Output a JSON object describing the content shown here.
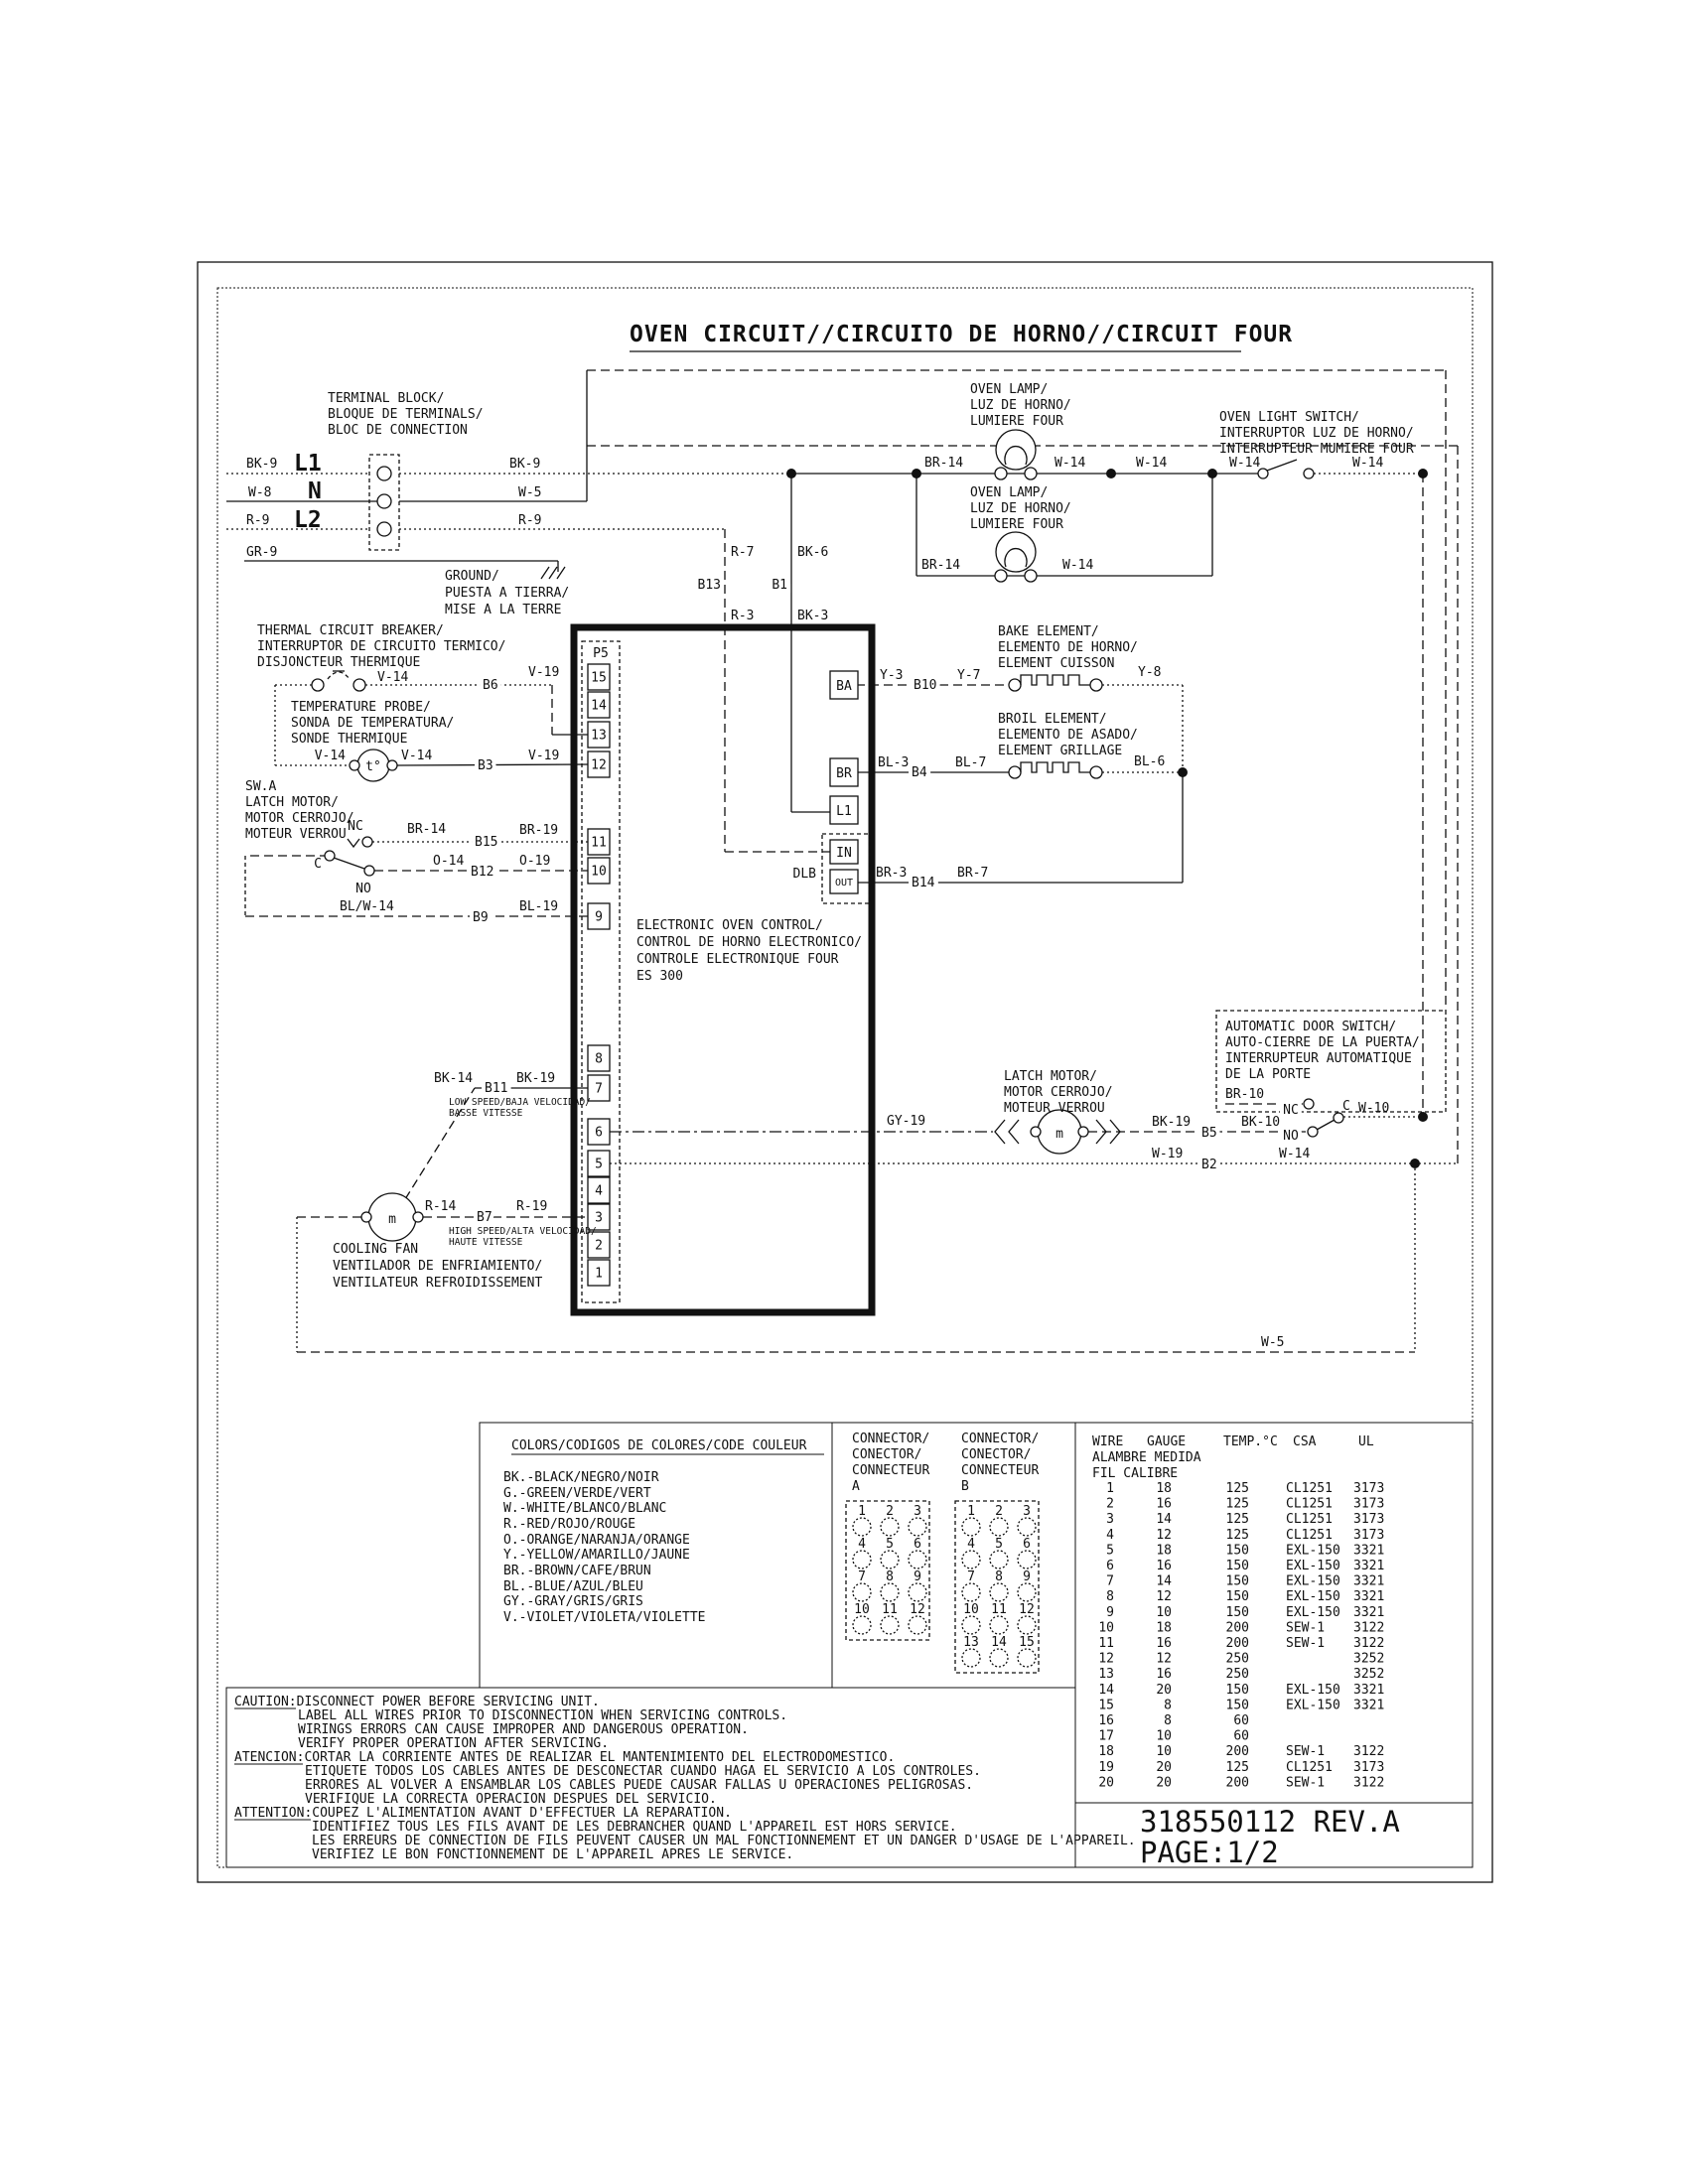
{
  "title": "OVEN CIRCUIT//CIRCUITO DE HORNO//CIRCUIT FOUR",
  "terminal": {
    "name": [
      "TERMINAL BLOCK/",
      "BLOQUE DE TERMINALS/",
      "BLOC DE CONNECTION"
    ],
    "l1": "L1",
    "n": "N",
    "l2": "L2",
    "bk9l": "BK-9",
    "w8": "W-8",
    "r9l": "R-9",
    "gr9": "GR-9",
    "bk9r": "BK-9",
    "w5": "W-5",
    "r9r": "R-9"
  },
  "ground": [
    "GROUND/",
    "PUESTA A TIERRA/",
    "MISE A LA TERRE"
  ],
  "breaker": {
    "name": [
      "THERMAL CIRCUIT BREAKER/",
      "INTERRUPTOR DE CIRCUITO TERMICO/",
      "DISJONCTEUR THERMIQUE"
    ],
    "v14": "V-14",
    "b6": "B6",
    "v19": "V-19"
  },
  "probe": {
    "name": [
      "TEMPERATURE PROBE/",
      "SONDA DE TEMPERATURA/",
      "SONDE THERMIQUE"
    ],
    "v14l": "V-14",
    "v14r": "V-14",
    "b3": "B3",
    "v19": "V-19",
    "t": "t°"
  },
  "swa": {
    "name": [
      "SW.A",
      "LATCH MOTOR/",
      "MOTOR CERROJO/",
      "MOTEUR VERROU"
    ],
    "nc": "NC",
    "no": "NO",
    "c": "C",
    "br14": "BR-14",
    "b15": "B15",
    "br19": "BR-19",
    "o14": "O-14",
    "b12": "B12",
    "o19": "O-19",
    "blw14": "BL/W-14",
    "b9": "B9",
    "bl19": "BL-19"
  },
  "control": {
    "p5": "P5",
    "pins": [
      "15",
      "14",
      "13",
      "12",
      "11",
      "10",
      "9",
      "8",
      "7",
      "6",
      "5",
      "4",
      "3",
      "2",
      "1"
    ],
    "name": [
      "ELECTRONIC OVEN CONTROL/",
      "CONTROL DE HORNO ELECTRONICO/",
      "CONTROLE ELECTRONIQUE FOUR",
      "ES 300"
    ],
    "ba": "BA",
    "br": "BR",
    "l1": "L1",
    "in": "IN",
    "out": "OUT",
    "dlb": "DLB"
  },
  "wires": {
    "r7": "R-7",
    "b13": "B13",
    "r3": "R-3",
    "bk6": "BK-6",
    "b1": "B1",
    "bk3": "BK-3",
    "w5": "W-5"
  },
  "lamps": {
    "lamp1": [
      "OVEN LAMP/",
      "LUZ DE HORNO/",
      "LUMIERE FOUR"
    ],
    "lamp2": [
      "OVEN LAMP/",
      "LUZ DE HORNO/",
      "LUMIERE FOUR"
    ],
    "br14a": "BR-14",
    "w14a": "W-14",
    "w14b": "W-14",
    "br14b": "BR-14",
    "w14c": "W-14"
  },
  "lightsw": {
    "name": [
      "OVEN LIGHT SWITCH/",
      "INTERRUPTOR LUZ DE HORNO/",
      "INTERRUPTEUR MUMIERE FOUR"
    ],
    "w14l": "W-14",
    "w14r": "W-14"
  },
  "bake": {
    "name": [
      "BAKE ELEMENT/",
      "ELEMENTO DE HORNO/",
      "ELEMENT CUISSON"
    ],
    "y3": "Y-3",
    "b10": "B10",
    "y7": "Y-7",
    "y8": "Y-8"
  },
  "broil": {
    "name": [
      "BROIL ELEMENT/",
      "ELEMENTO DE ASADO/",
      "ELEMENT GRILLAGE"
    ],
    "bl3": "BL-3",
    "b4": "B4",
    "bl7": "BL-7",
    "bl6": "BL-6"
  },
  "dlbline": {
    "br3": "BR-3",
    "b14": "B14",
    "br7": "BR-7"
  },
  "fan": {
    "name": [
      "COOLING FAN",
      "VENTILADOR DE ENFRIAMIENTO/",
      "VENTILATEUR REFROIDISSEMENT"
    ],
    "bk14": "BK-14",
    "b11": "B11",
    "bk19": "BK-19",
    "low": [
      "LOW SPEED/BAJA VELOCIDAD/",
      "BASSE VITESSE"
    ],
    "r14": "R-14",
    "b7": "B7",
    "r19": "R-19",
    "high": [
      "HIGH SPEED/ALTA VELOCIDAD/",
      "HAUTE VITESSE"
    ],
    "m": "m"
  },
  "latch": {
    "name": [
      "LATCH MOTOR/",
      "MOTOR CERROJO/",
      "MOTEUR VERROU"
    ],
    "gy19": "GY-19",
    "bk19": "BK-19",
    "b5": "B5",
    "bk10": "BK-10",
    "w19": "W-19",
    "b2": "B2",
    "w14": "W-14",
    "m": "m"
  },
  "door": {
    "name": [
      "AUTOMATIC DOOR SWITCH/",
      "AUTO-CIERRE DE LA PUERTA/",
      "INTERRUPTEUR AUTOMATIQUE",
      "DE LA PORTE"
    ],
    "br10": "BR-10",
    "nc": "NC",
    "no": "NO",
    "c": "C",
    "w10": "W-10"
  },
  "colors": {
    "title": "COLORS/CODIGOS DE COLORES/CODE COULEUR",
    "items": [
      "BK.-BLACK/NEGRO/NOIR",
      "G.-GREEN/VERDE/VERT",
      "W.-WHITE/BLANCO/BLANC",
      "R.-RED/ROJO/ROUGE",
      "O.-ORANGE/NARANJA/ORANGE",
      "Y.-YELLOW/AMARILLO/JAUNE",
      "BR.-BROWN/CAFE/BRUN",
      "BL.-BLUE/AZUL/BLEU",
      "GY.-GRAY/GRIS/GRIS",
      "V.-VIOLET/VIOLETA/VIOLETTE"
    ]
  },
  "connA": {
    "name": [
      "CONNECTOR/",
      "CONECTOR/",
      "CONNECTEUR",
      "A"
    ],
    "count": 12
  },
  "connB": {
    "name": [
      "CONNECTOR/",
      "CONECTOR/",
      "CONNECTEUR",
      "B"
    ],
    "count": 15
  },
  "wiretable": {
    "h1": [
      "WIRE",
      "GAUGE",
      "TEMP.°C",
      "CSA",
      "UL"
    ],
    "h2": "ALAMBRE MEDIDA",
    "h3": "FIL  CALIBRE",
    "rows": [
      [
        "1",
        "18",
        "125",
        "CL1251",
        "3173"
      ],
      [
        "2",
        "16",
        "125",
        "CL1251",
        "3173"
      ],
      [
        "3",
        "14",
        "125",
        "CL1251",
        "3173"
      ],
      [
        "4",
        "12",
        "125",
        "CL1251",
        "3173"
      ],
      [
        "5",
        "18",
        "150",
        "EXL-150",
        "3321"
      ],
      [
        "6",
        "16",
        "150",
        "EXL-150",
        "3321"
      ],
      [
        "7",
        "14",
        "150",
        "EXL-150",
        "3321"
      ],
      [
        "8",
        "12",
        "150",
        "EXL-150",
        "3321"
      ],
      [
        "9",
        "10",
        "150",
        "EXL-150",
        "3321"
      ],
      [
        "10",
        "18",
        "200",
        "SEW-1",
        "3122"
      ],
      [
        "11",
        "16",
        "200",
        "SEW-1",
        "3122"
      ],
      [
        "12",
        "12",
        "250",
        "",
        "3252"
      ],
      [
        "13",
        "16",
        "250",
        "",
        "3252"
      ],
      [
        "14",
        "20",
        "150",
        "EXL-150",
        "3321"
      ],
      [
        "15",
        "8",
        "150",
        "EXL-150",
        "3321"
      ],
      [
        "16",
        "8",
        "60",
        "",
        ""
      ],
      [
        "17",
        "10",
        "60",
        "",
        ""
      ],
      [
        "18",
        "10",
        "200",
        "SEW-1",
        "3122"
      ],
      [
        "19",
        "20",
        "125",
        "CL1251",
        "3173"
      ],
      [
        "20",
        "20",
        "200",
        "SEW-1",
        "3122"
      ]
    ]
  },
  "caution": {
    "lines": [
      "CAUTION:DISCONNECT POWER BEFORE SERVICING UNIT.",
      "LABEL ALL WIRES PRIOR TO DISCONNECTION WHEN SERVICING CONTROLS.",
      "WIRINGS ERRORS CAN CAUSE IMPROPER AND DANGEROUS OPERATION.",
      "VERIFY PROPER OPERATION AFTER SERVICING.",
      "ATENCION:CORTAR LA CORRIENTE ANTES DE REALIZAR EL MANTENIMIENTO DEL ELECTRODOMESTICO.",
      "ETIQUETE TODOS LOS CABLES ANTES DE DESCONECTAR CUANDO HAGA EL SERVICIO A LOS CONTROLES.",
      "ERRORES AL VOLVER A ENSAMBLAR LOS CABLES PUEDE CAUSAR FALLAS U OPERACIONES PELIGROSAS.",
      "VERIFIQUE LA CORRECTA OPERACION DESPUES DEL SERVICIO.",
      "ATTENTION:COUPEZ L'ALIMENTATION AVANT D'EFFECTUER LA REPARATION.",
      "IDENTIFIEZ TOUS LES FILS AVANT DE LES DEBRANCHER QUAND L'APPAREIL EST HORS SERVICE.",
      "LES ERREURS DE CONNECTION DE FILS PEUVENT CAUSER UN MAL FONCTIONNEMENT ET UN DANGER D'USAGE DE L'APPAREIL.",
      "VERIFIEZ LE BON FONCTIONNEMENT DE L'APPAREIL APRES LE SERVICE."
    ]
  },
  "part": {
    "number": "318550112 REV.A",
    "page": "PAGE:1/2"
  }
}
